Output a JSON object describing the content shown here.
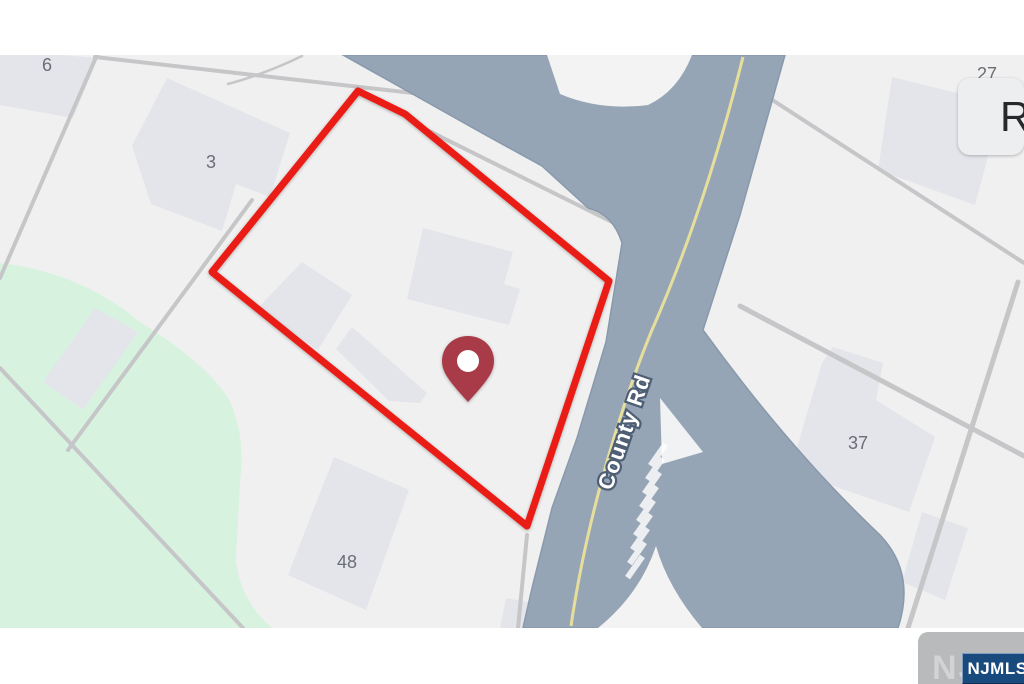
{
  "map": {
    "road_label": "County Rd",
    "parcel_labels": [
      {
        "text": "6"
      },
      {
        "text": "3"
      },
      {
        "text": "27"
      },
      {
        "text": "37"
      },
      {
        "text": "48"
      }
    ],
    "marker": {
      "name": "location-pin"
    },
    "colors": {
      "map_bg": "#f0f0f1",
      "green_area": "#d7f3df",
      "building": "#e3e5ea",
      "parcel_line": "#c6c6c8",
      "road": "#96a5b5",
      "road_edge": "#8899ac",
      "center_line_yellow": "#e6df9c",
      "boundary_red": "#ea1a12",
      "pin": "#a83a46"
    }
  },
  "overlays": {
    "top_right_button_label": "R",
    "watermark_text": "NJMLS",
    "brand_badge_text": "NJMLS"
  }
}
